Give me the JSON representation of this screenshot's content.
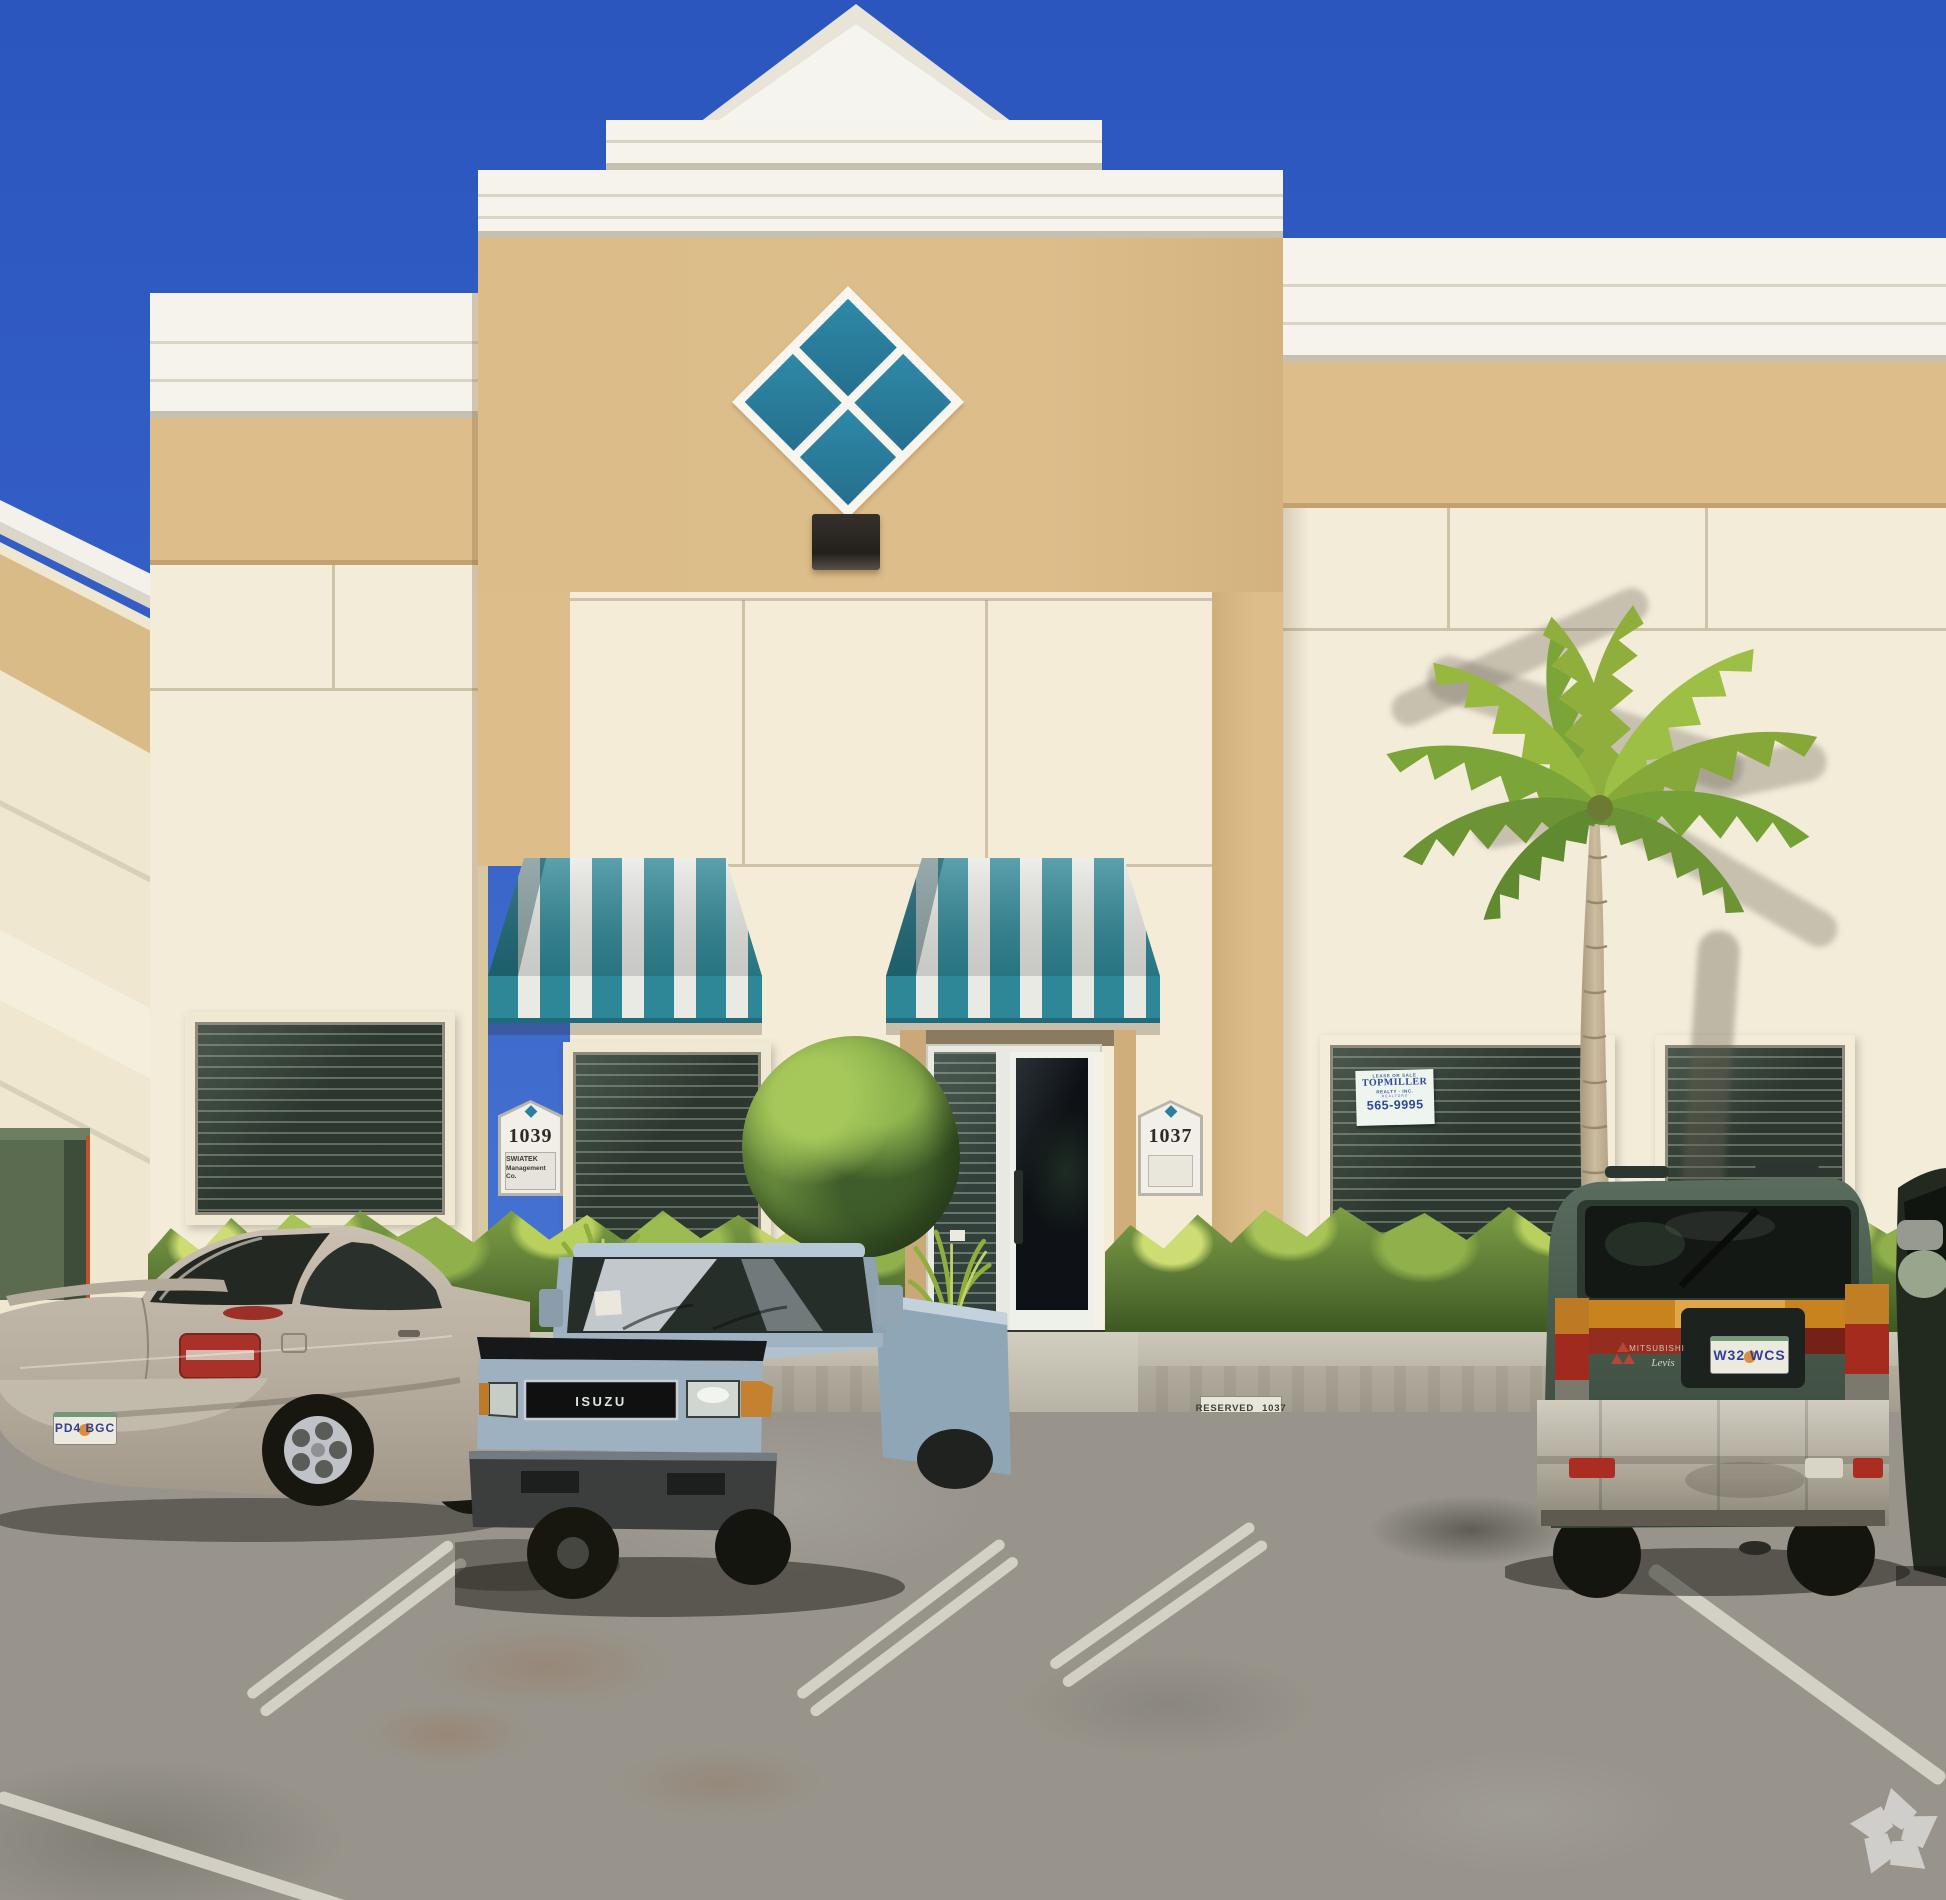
{
  "colors": {
    "sky-top": "#2a56bd",
    "sky-bottom": "#4a79d6",
    "wall-tan": "#ddbe8b",
    "wall-cream": "#f3ecd9",
    "cornice-white": "#f5f3ec",
    "awning-teal": "#2e8796",
    "awning-stripe-white": "#e9eae4",
    "logo-teal": "#2a7f9e",
    "hedge-green": "#5c7a36",
    "palm-green": "#86a838",
    "asphalt-gray": "#98948b",
    "curb-gray": "#bdb8aa",
    "sedan-silver": "#b6ad9e",
    "truck-blue": "#a9bdcb",
    "van-green": "#46584a",
    "plate-text-blue": "#323f96",
    "sign-navy": "#2b4a94",
    "signal-amber": "#c8831f",
    "signal-red": "#a5281e"
  },
  "building": {
    "unit_1039": {
      "number": "1039",
      "tenant_line1": "SWIATEK",
      "tenant_line2": "Management",
      "tenant_line3": "Co."
    },
    "unit_1037": {
      "number": "1037"
    },
    "window_sign": {
      "line1": "LEASE OR SALE",
      "line2": "TOPMILLER",
      "line3": "REALTY · INC.",
      "line4": "REALTORS",
      "phone": "565-9995"
    },
    "curb_sign": {
      "label": "RESERVED",
      "unit": "1037"
    }
  },
  "vehicles": {
    "sedan": {
      "plate": "PD4 BGC"
    },
    "pickup": {
      "grille_badge": "ISUZU"
    },
    "van": {
      "plate": "W32 WCS",
      "make_badge": "MITSUBISHI",
      "model_badge": "Levis"
    }
  },
  "watermark": {
    "icon": "recycle-pinwheel-icon"
  }
}
